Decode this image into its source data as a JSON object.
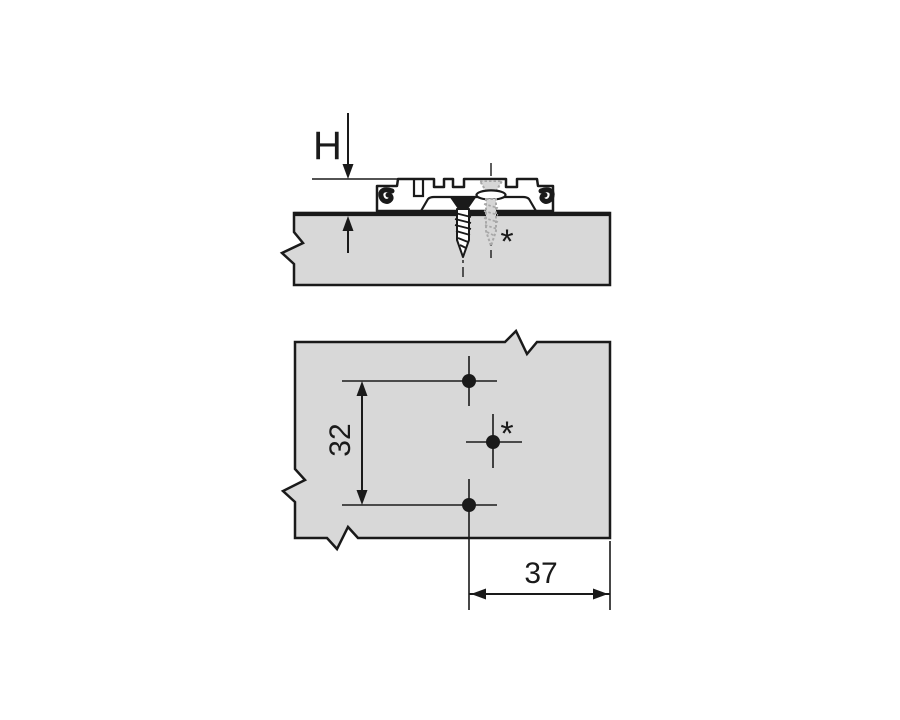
{
  "figure": {
    "type": "technical-installation-drawing",
    "subject": "cruciform hinge mounting plate on panel",
    "side_view": {
      "description": "side elevation of mounting plate seated on panel with fixing screw and pre-mounted screw",
      "height_dimension_label": "H",
      "premounted_screw_marker": "*"
    },
    "plan_view": {
      "description": "drilling pattern on panel",
      "hole_spacing_vertical_label": "32",
      "edge_distance_horizontal_label": "37",
      "premounted_screw_marker": "*",
      "hole_count": 3
    },
    "colors": {
      "background": "#ffffff",
      "line": "#1a1a1a",
      "panel_fill": "#d8d8d8",
      "premounted_screw": "#a8a8a8"
    }
  }
}
